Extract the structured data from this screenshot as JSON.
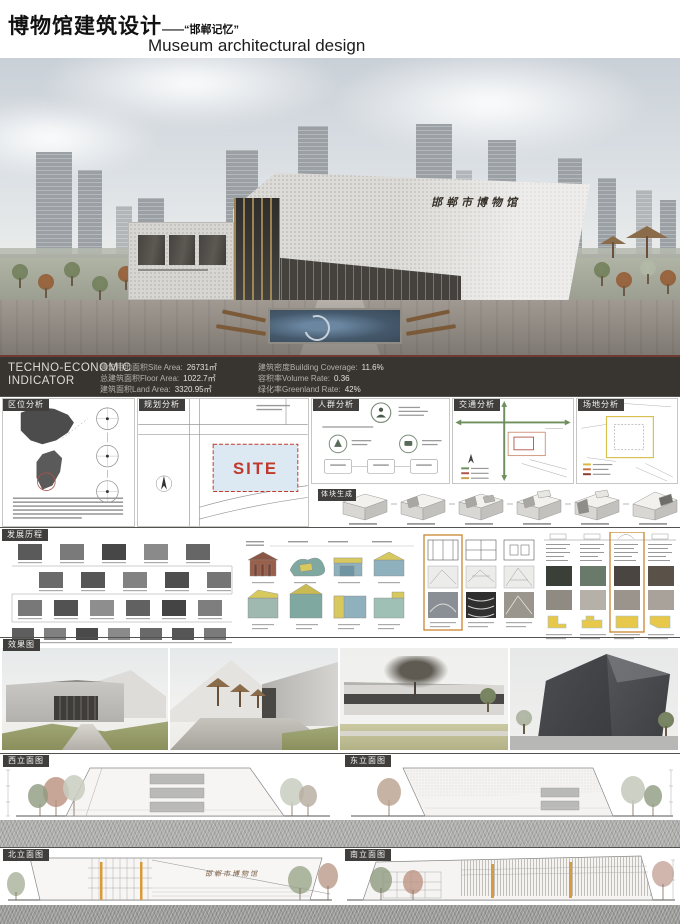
{
  "header": {
    "title_zh": "博物馆建筑设计",
    "title_dash": "——",
    "title_theme": "“邯郸记忆”",
    "title_en": "Museum architectural design"
  },
  "hero": {
    "building_sign": "邯郸市博物馆"
  },
  "indicator": {
    "title_line1": "TECHNO-ECONOMIC",
    "title_line2": "INDICATOR",
    "stats_col1": [
      {
        "label": "建筑用地面积Site Area:",
        "value": "26731㎡"
      },
      {
        "label": "总建筑面积Floor Area:",
        "value": "1022.7㎡"
      },
      {
        "label": "建筑面积Land Area:",
        "value": "3320.95㎡"
      }
    ],
    "stats_col2": [
      {
        "label": "建筑密度Building Coverage:",
        "value": "11.6%"
      },
      {
        "label": "容积率Volume Rate:",
        "value": "0.36"
      },
      {
        "label": "绿化率Greenland Rate:",
        "value": "42%"
      }
    ]
  },
  "sections": {
    "location": "区位分析",
    "planning": "规划分析",
    "crowd": "人群分析",
    "traffic": "交通分析",
    "site": "场地分析",
    "massing": "体块生成",
    "history": "发展历程",
    "renderings": "效果图",
    "elev_west": "西立面图",
    "elev_east": "东立面图",
    "elev_north": "北立面图",
    "elev_south": "南立面图"
  },
  "planning_panel": {
    "site_label": "SITE"
  },
  "elevations": {
    "building_sign": "邯郸市博物馆"
  }
}
